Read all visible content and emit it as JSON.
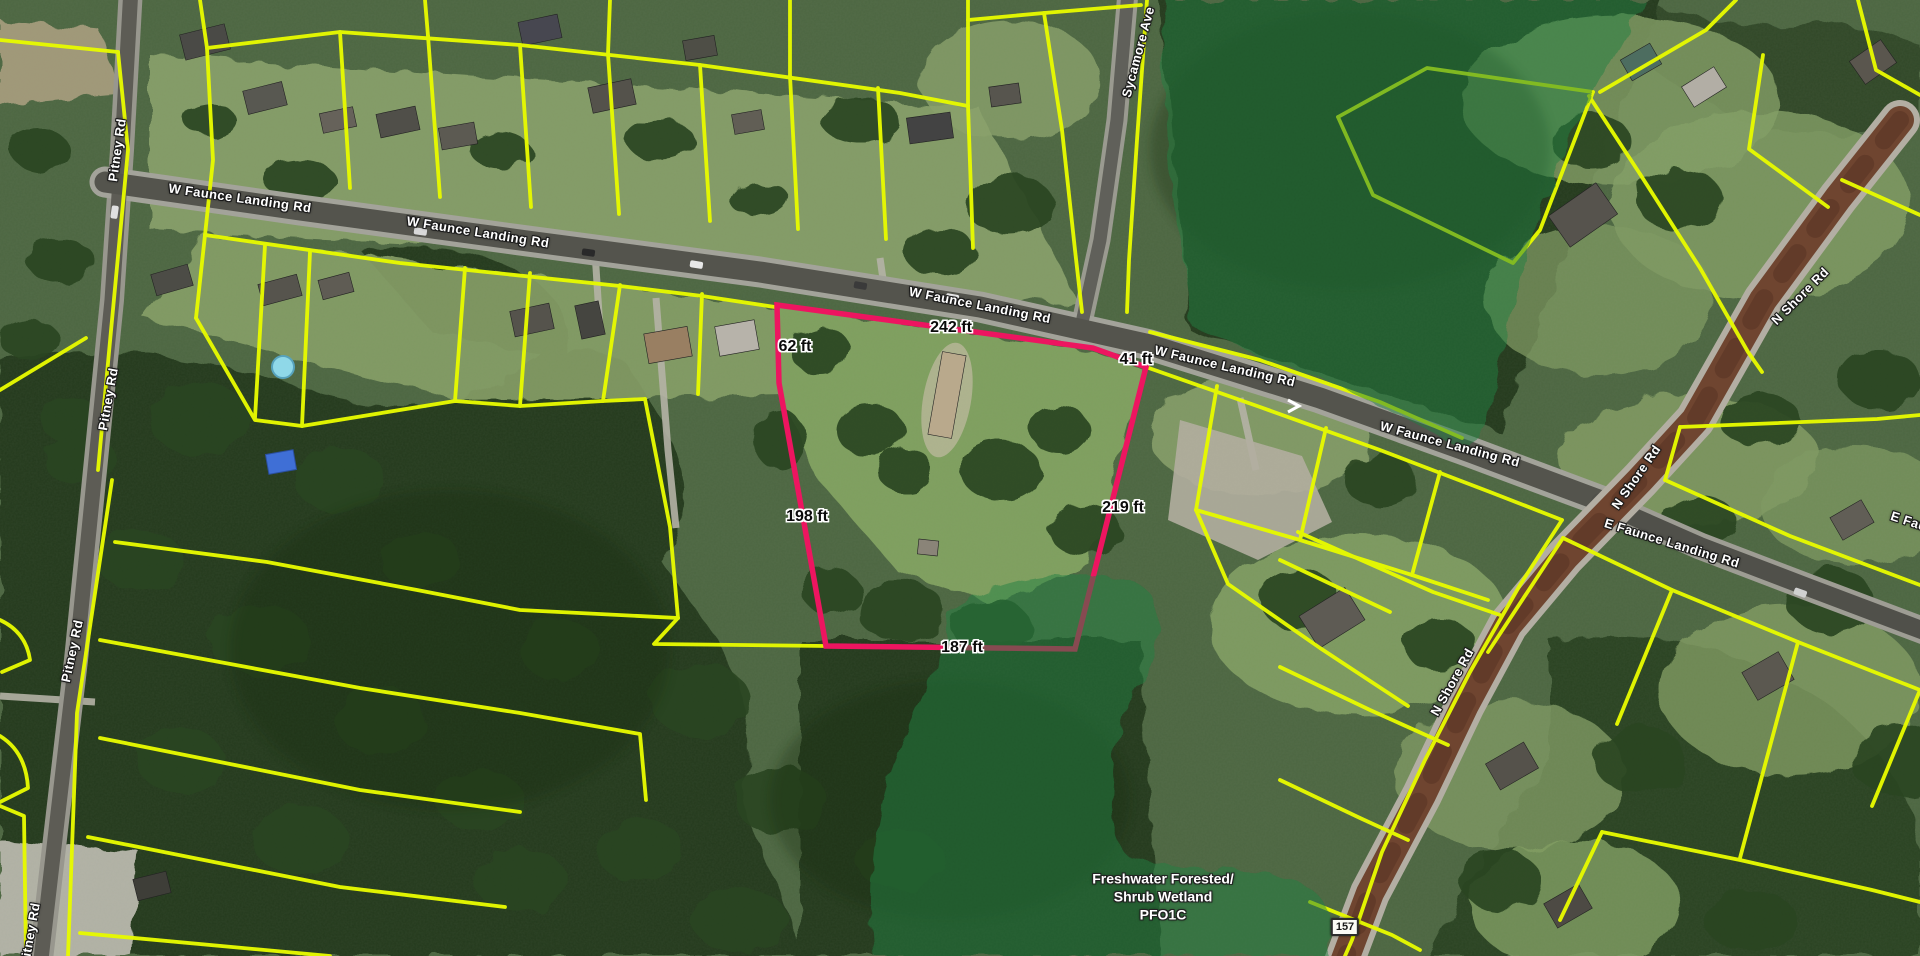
{
  "map": {
    "view": "satellite-parcel-viewer",
    "road_labels": [
      {
        "text": "Pitney Rd",
        "x": 117,
        "y": 150,
        "rot": -82
      },
      {
        "text": "Pitney Rd",
        "x": 108,
        "y": 399,
        "rot": -80
      },
      {
        "text": "Pitney Rd",
        "x": 72,
        "y": 651,
        "rot": -78
      },
      {
        "text": "Pitney Rd",
        "x": 30,
        "y": 934,
        "rot": -80
      },
      {
        "text": "W Faunce Landing Rd",
        "x": 240,
        "y": 198,
        "rot": 8
      },
      {
        "text": "W Faunce Landing Rd",
        "x": 478,
        "y": 232,
        "rot": 9
      },
      {
        "text": "W Faunce Landing Rd",
        "x": 980,
        "y": 305,
        "rot": 11
      },
      {
        "text": "W Faunce Landing Rd",
        "x": 1225,
        "y": 366,
        "rot": 13
      },
      {
        "text": "W Faunce Landing Rd",
        "x": 1450,
        "y": 444,
        "rot": 15
      },
      {
        "text": "Sycamore Ave",
        "x": 1138,
        "y": 52,
        "rot": -75
      },
      {
        "text": "N Shore Rd",
        "x": 1800,
        "y": 296,
        "rot": -45
      },
      {
        "text": "N Shore Rd",
        "x": 1636,
        "y": 477,
        "rot": -55
      },
      {
        "text": "N Shore Rd",
        "x": 1452,
        "y": 682,
        "rot": -61
      },
      {
        "text": "E Faunce Landing Rd",
        "x": 1672,
        "y": 543,
        "rot": 17
      },
      {
        "text": "E Faunce Landing Rd",
        "x": 1958,
        "y": 537,
        "rot": 18
      }
    ],
    "dimension_labels": [
      {
        "text": "242 ft",
        "x": 951,
        "y": 328
      },
      {
        "text": "62 ft",
        "x": 795,
        "y": 347
      },
      {
        "text": "41 ft",
        "x": 1136,
        "y": 360
      },
      {
        "text": "198 ft",
        "x": 807,
        "y": 517
      },
      {
        "text": "219 ft",
        "x": 1123,
        "y": 508
      },
      {
        "text": "187 ft",
        "x": 962,
        "y": 648
      }
    ],
    "highlight_parcel": {
      "outline_color": "#ED1560",
      "dimensions": [
        "242 ft",
        "62 ft",
        "41 ft",
        "198 ft",
        "219 ft",
        "187 ft"
      ]
    },
    "wetland_label": {
      "line1": "Freshwater Forested/",
      "line2": "Shrub Wetland",
      "line3": "PFO1C",
      "x": 1163,
      "y": 897
    },
    "route_shield": {
      "text": "157",
      "x": 1345,
      "y": 927
    },
    "colors": {
      "parcel_line": "#E6F900",
      "highlight_parcel": "#ED1560",
      "wetland_fill": "#1E8040",
      "road_gray": "#54544D",
      "road_nshore_brown": "#6F4530"
    }
  }
}
